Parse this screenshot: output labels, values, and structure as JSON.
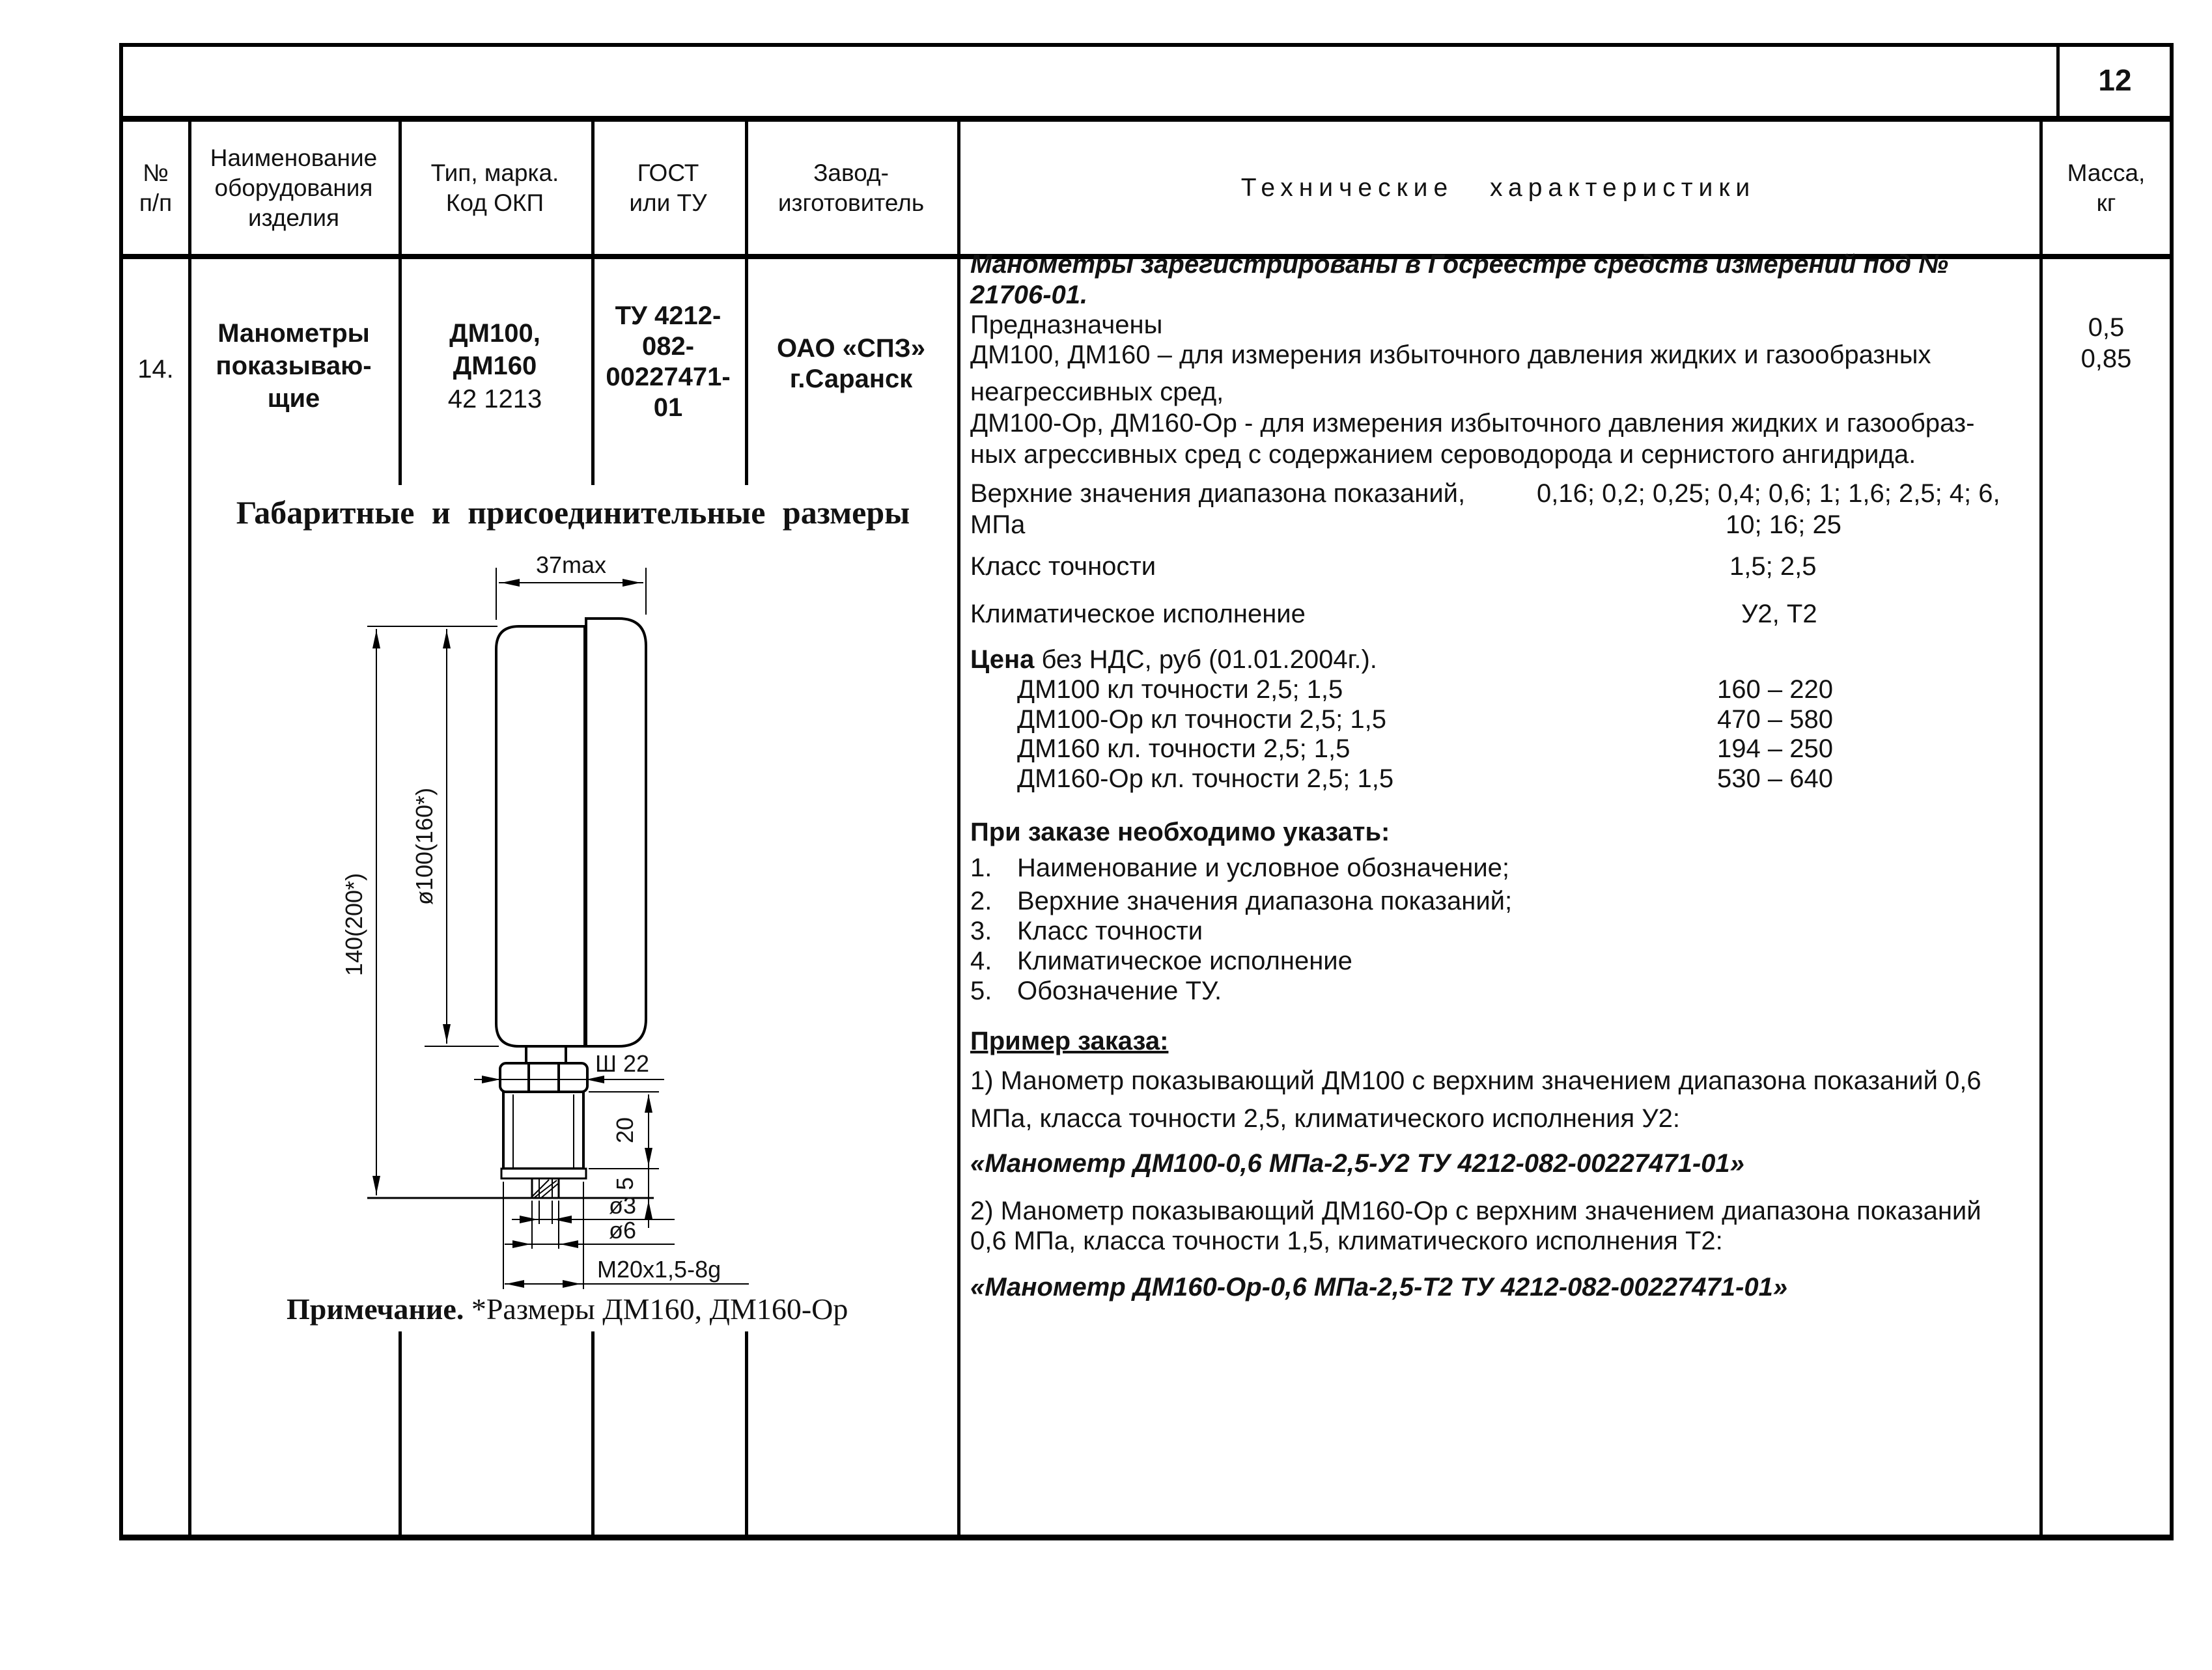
{
  "page": {
    "number": "12"
  },
  "table": {
    "headers": {
      "num": "№\nп/п",
      "name": "Наименование\nоборудования\nизделия",
      "type": "Тип, марка.\nКод ОКП",
      "gost": "ГОСТ\nили ТУ",
      "factory": "Завод-\nизготовитель",
      "tech": "Технические характеристики",
      "mass": "Масса,\nкг"
    }
  },
  "row": {
    "num": "14.",
    "name": "Манометры\nпоказываю-\nщие",
    "type_bold": "ДМ100,\nДМ160",
    "type_code": "42 1213",
    "gost": "ТУ 4212-\n082-\n00227471-\n01",
    "factory": "ОАО «СПЗ»\nг.Саранск",
    "mass": "0,5\n0,85"
  },
  "tech": {
    "registered_1": "Манометры зарегистрированы в Госреестре средств измерений под №",
    "registered_2": "21706-01.",
    "purpose_intro": "Предназначены",
    "purpose_1": "ДМ100, ДМ160 – для измерения избыточного давления жидких и газообразных",
    "purpose_2": "неагрессивных сред,",
    "purpose_3": "ДМ100-Ор, ДМ160-Ор - для измерения избыточного давления жидких и газообраз-",
    "purpose_4": "ных агрессивных сред с содержанием сероводорода  и сернистого ангидрида.",
    "range_label": "Верхние значения диапазона показаний,",
    "range_label2": "МПа",
    "range_values1": "0,16; 0,2; 0,25; 0,4; 0,6; 1; 1,6; 2,5; 4; 6,",
    "range_values2": "10; 16; 25",
    "accuracy_label": "Класс точности",
    "accuracy_values": "1,5;  2,5",
    "climate_label": "Климатическое исполнение",
    "climate_values": "У2,  Т2",
    "price_label_bold": "Цена",
    "price_label_rest": " без НДС, руб (01.01.2004г.).",
    "price_items": [
      {
        "label": "ДМ100 кл  точности 2,5; 1,5",
        "value": "160 – 220"
      },
      {
        "label": "ДМ100-Ор кл  точности 2,5; 1,5",
        "value": "470 – 580"
      },
      {
        "label": "ДМ160 кл. точности 2,5; 1,5",
        "value": "194 – 250"
      },
      {
        "label": "ДМ160-Ор кл. точности 2,5; 1,5",
        "value": "530 – 640"
      }
    ],
    "order_heading": "При заказе необходимо указать:",
    "order_items": [
      {
        "num": "1.",
        "text": "Наименование и условное обозначение;"
      },
      {
        "num": "2.",
        "text": "Верхние значения диапазона показаний;"
      },
      {
        "num": "3.",
        "text": "Класс точности"
      },
      {
        "num": "4.",
        "text": "Климатическое исполнение"
      },
      {
        "num": "5.",
        "text": "Обозначение ТУ."
      }
    ],
    "example_heading": "Пример заказа:",
    "example1_line1": "1) Манометр показывающий ДМ100 с верхним значением диапазона показаний 0,6",
    "example1_line2": "МПа, класса точности 2,5, климатического исполнения У2:",
    "example1_code": "«Манометр ДМ100-0,6 МПа-2,5-У2 ТУ 4212-082-00227471-01»",
    "example2_line1": "2) Манометр показывающий ДМ160-Ор с верхним значением диапазона показаний",
    "example2_line2": "0,6 МПа, класса точности 1,5, климатического исполнения Т2:",
    "example2_code": "«Манометр ДМ160-Ор-0,6 МПа-2,5-Т2 ТУ 4212-082-00227471-01»"
  },
  "drawing": {
    "title": "Габаритные  и  присоединительные  размеры",
    "dims": {
      "width_top": "37max",
      "height_total": "140(200*)",
      "diameter": "ø100(160*)",
      "wrench": "Ш 22",
      "thread_len": "20",
      "tail_len": "5",
      "hole_small": "ø3",
      "hole_big": "ø6",
      "thread": "M20x1,5-8g"
    },
    "note_bold": "Примечание.",
    "note_rest": "  *Размеры  ДМ160,  ДМ160-Ор"
  }
}
